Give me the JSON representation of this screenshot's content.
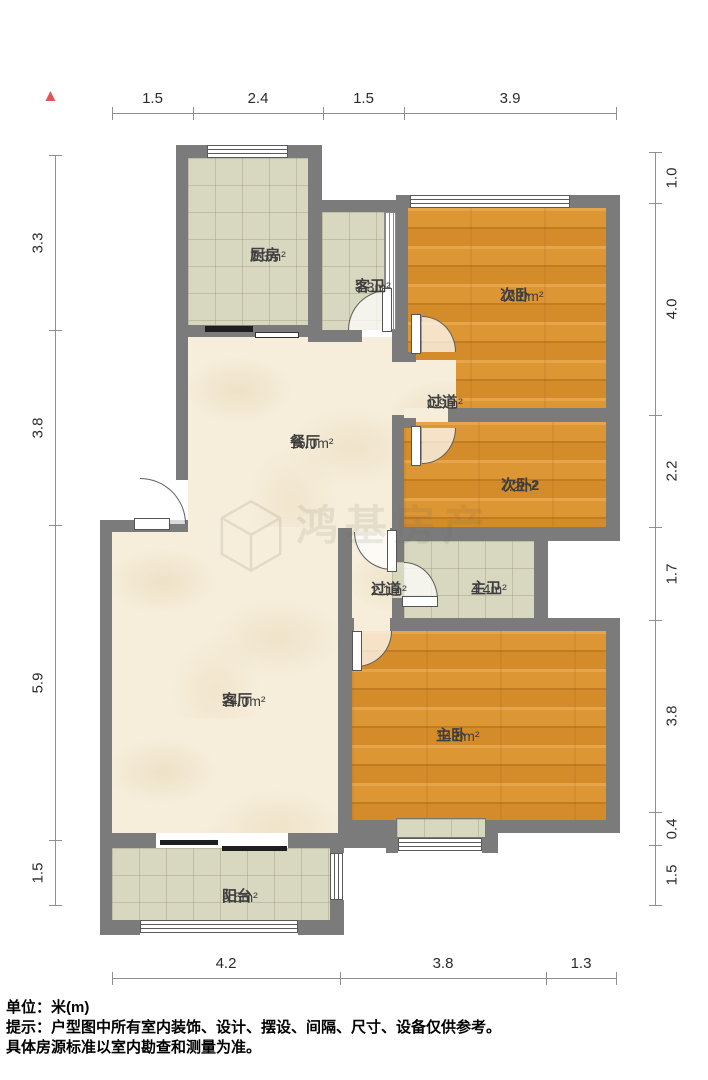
{
  "compass": {
    "symbol": "▲",
    "color": "#e05555"
  },
  "rooms": [
    {
      "id": "kitchen",
      "name": "厨房",
      "area": "7.3m²",
      "cx": 250,
      "cy": 247
    },
    {
      "id": "guest-bathroom",
      "name": "客卫",
      "area": "3.3m²",
      "cx": 355,
      "cy": 278
    },
    {
      "id": "bedroom-second",
      "name": "次卧",
      "area": "13.0m²",
      "cx": 500,
      "cy": 287
    },
    {
      "id": "corridor-small",
      "name": "过道",
      "area": "0.9m²",
      "cx": 427,
      "cy": 394
    },
    {
      "id": "dining-room",
      "name": "餐厅",
      "area": "15.0m²",
      "cx": 290,
      "cy": 434
    },
    {
      "id": "bedroom-second-2",
      "name": "次卧2",
      "area": "7.2m²",
      "cx": 501,
      "cy": 477
    },
    {
      "id": "corridor",
      "name": "过道",
      "area": "2.1m²",
      "cx": 371,
      "cy": 581
    },
    {
      "id": "master-bathroom",
      "name": "主卫",
      "area": "4.4m²",
      "cx": 471,
      "cy": 580
    },
    {
      "id": "living-room",
      "name": "客厅",
      "area": "24.0m²",
      "cx": 222,
      "cy": 692
    },
    {
      "id": "master-bedroom",
      "name": "主卧",
      "area": "14.5m²",
      "cx": 436,
      "cy": 727
    },
    {
      "id": "balcony",
      "name": "阳台",
      "area": "5.5m²",
      "cx": 222,
      "cy": 888
    }
  ],
  "dimensions": {
    "unit": "米(m)",
    "top": {
      "labels": [
        "1.5",
        "2.4",
        "1.5",
        "3.9"
      ],
      "ticks": [
        112,
        193,
        323,
        404,
        616
      ],
      "line_y": 113
    },
    "bottom": {
      "labels": [
        "4.2",
        "3.8",
        "1.3"
      ],
      "ticks": [
        112,
        340,
        546,
        616
      ],
      "line_y": 978
    },
    "left": {
      "labels": [
        "3.3",
        "3.8",
        "5.9",
        "1.5"
      ],
      "ticks": [
        155,
        330,
        525,
        840,
        905
      ],
      "line_x": 55
    },
    "right": {
      "labels": [
        "1.0",
        "4.0",
        "2.2",
        "1.7",
        "3.8",
        "0.4",
        "1.5"
      ],
      "ticks": [
        152,
        203,
        415,
        527,
        620,
        812,
        845,
        905
      ],
      "line_x": 655
    }
  },
  "watermark": {
    "brand": "鸿基房产"
  },
  "footer": {
    "line1": "单位：米(m)",
    "line2": "提示：户型图中所有室内装饰、设计、摆设、间隔、尺寸、设备仅供参考。",
    "line3": "具体房源标准以室内勘查和测量为准。"
  },
  "colors": {
    "wall": "#7b7b7b",
    "wood": "#dd9634",
    "tile": "#d8d7bf",
    "marble": "#f6eedb",
    "accent_red": "#e05555"
  }
}
